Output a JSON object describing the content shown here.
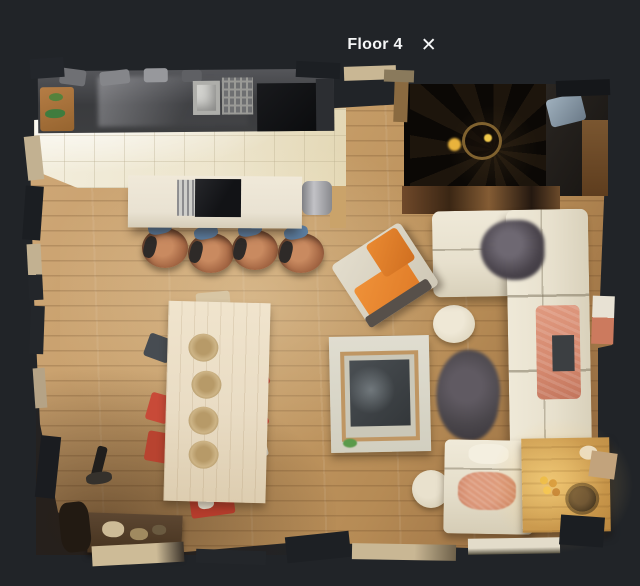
{
  "header": {
    "title": "Floor 4",
    "close_glyph": "✕"
  },
  "icons": {
    "close": "close-x"
  },
  "colors": {
    "background": "#212428",
    "header_text": "#f5f6f7",
    "wood_light": "#cfa878",
    "wood_dark": "#8a6038",
    "tile": "#ece4cc",
    "counter": "#3d3e40",
    "island_top": "#e9e2d2",
    "sofa": "#e7e0cd",
    "blanket": "#d4886e",
    "armchair": "#e07c28",
    "rug": "#4a464b",
    "dining_table": "#e9dcc4",
    "chair_red": "#c84a38",
    "side_table": "#cfa055"
  }
}
